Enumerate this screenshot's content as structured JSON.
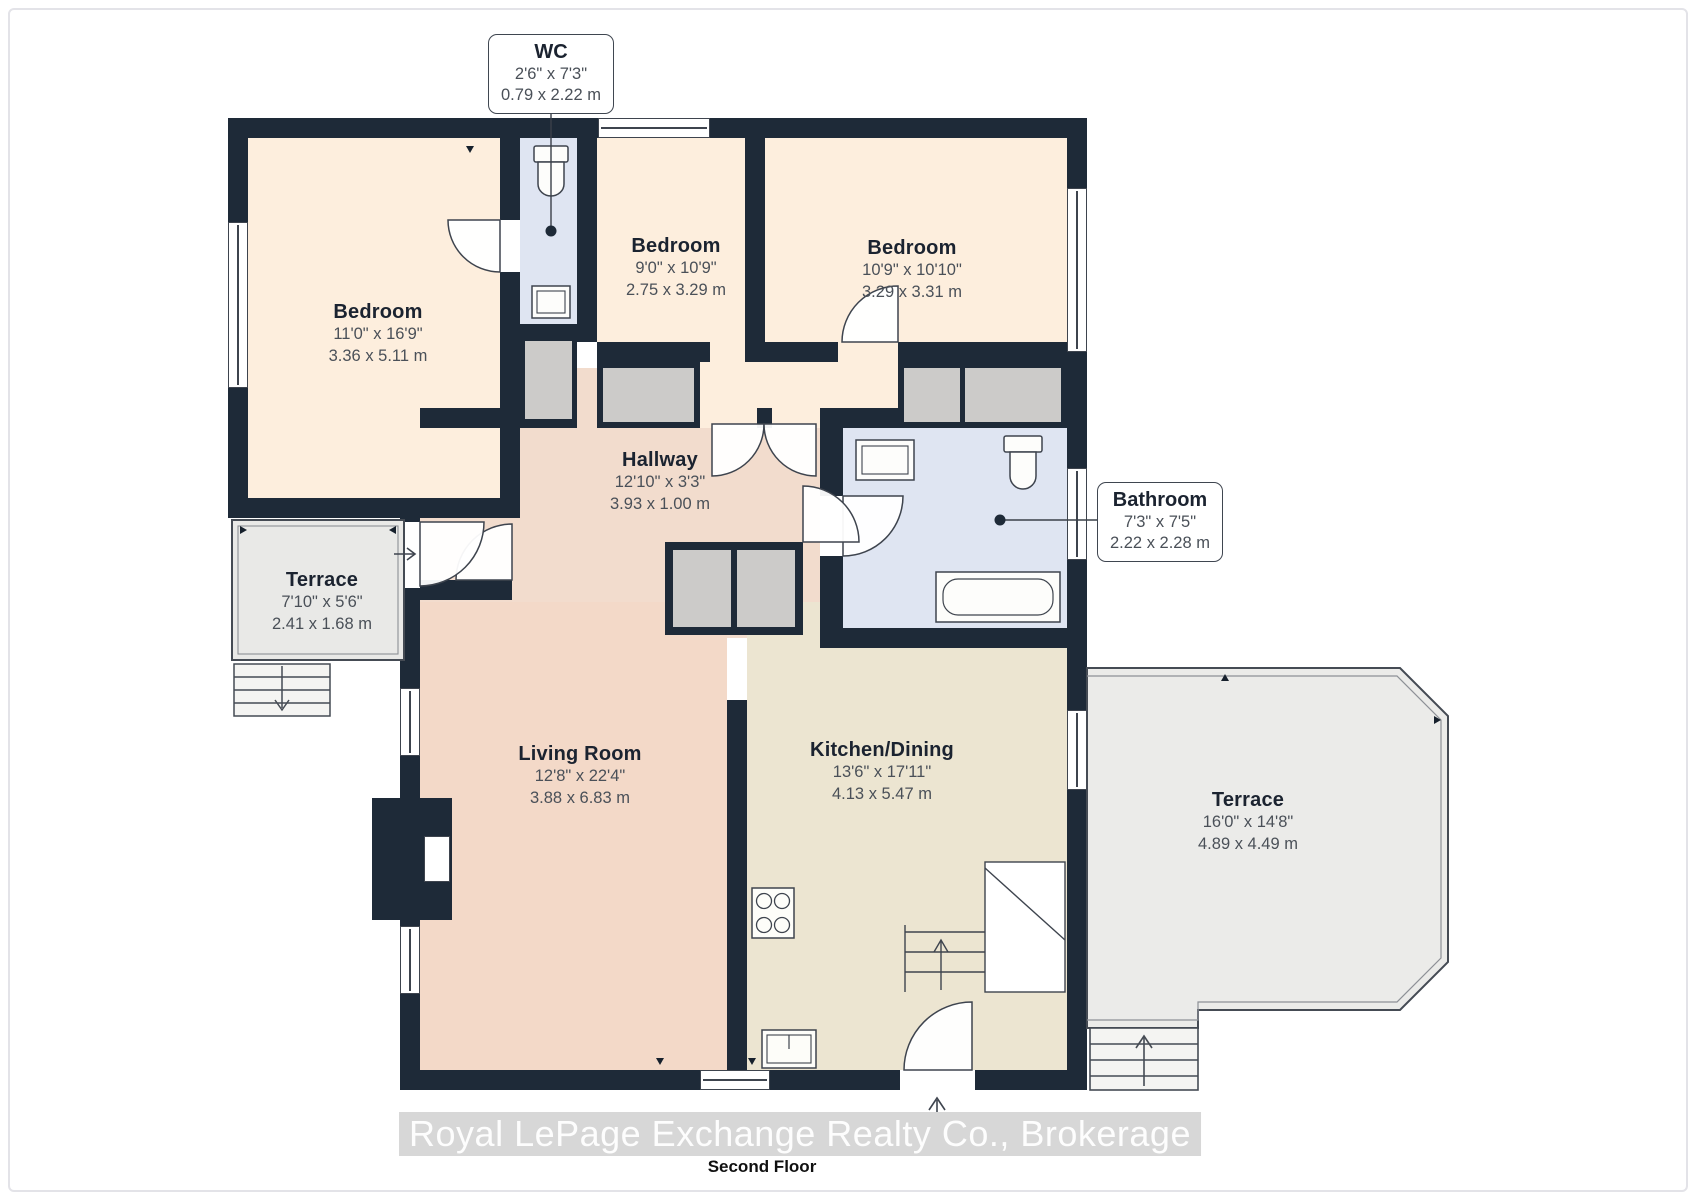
{
  "floorplan": {
    "caption": "Second Floor",
    "watermark": "Royal LePage Exchange Realty Co., Brokerage",
    "colors": {
      "wall": "#1e2a38",
      "outline": "#3e444e",
      "bedroom_fill": "#fdeedd",
      "hallway_fill": "#f2dccd",
      "living_fill": "#f3d9c8",
      "kitchen_fill": "#ece5d1",
      "bath_fill": "#dfe5f2",
      "terrace_fill": "#eaeae8",
      "closet_fill": "#cccbc9"
    },
    "rooms": [
      {
        "name": "Bedroom",
        "imperial": "11'0\" x 16'9\"",
        "metric": "3.36 x 5.11 m"
      },
      {
        "name": "Bedroom",
        "imperial": "9'0\" x 10'9\"",
        "metric": "2.75 x 3.29 m"
      },
      {
        "name": "Bedroom",
        "imperial": "10'9\" x 10'10\"",
        "metric": "3.29 x 3.31 m"
      },
      {
        "name": "Hallway",
        "imperial": "12'10\" x 3'3\"",
        "metric": "3.93 x 1.00 m"
      },
      {
        "name": "Terrace",
        "imperial": "7'10\" x 5'6\"",
        "metric": "2.41 x 1.68 m"
      },
      {
        "name": "Living Room",
        "imperial": "12'8\" x 22'4\"",
        "metric": "3.88 x 6.83 m"
      },
      {
        "name": "Kitchen/Dining",
        "imperial": "13'6\" x 17'11\"",
        "metric": "4.13 x 5.47 m"
      },
      {
        "name": "Terrace",
        "imperial": "16'0\" x 14'8\"",
        "metric": "4.89 x 4.49 m"
      }
    ],
    "callouts": [
      {
        "name": "WC",
        "imperial": "2'6\" x 7'3\"",
        "metric": "0.79 x 2.22 m"
      },
      {
        "name": "Bathroom",
        "imperial": "7'3\" x 7'5\"",
        "metric": "2.22 x 2.28 m"
      }
    ]
  }
}
